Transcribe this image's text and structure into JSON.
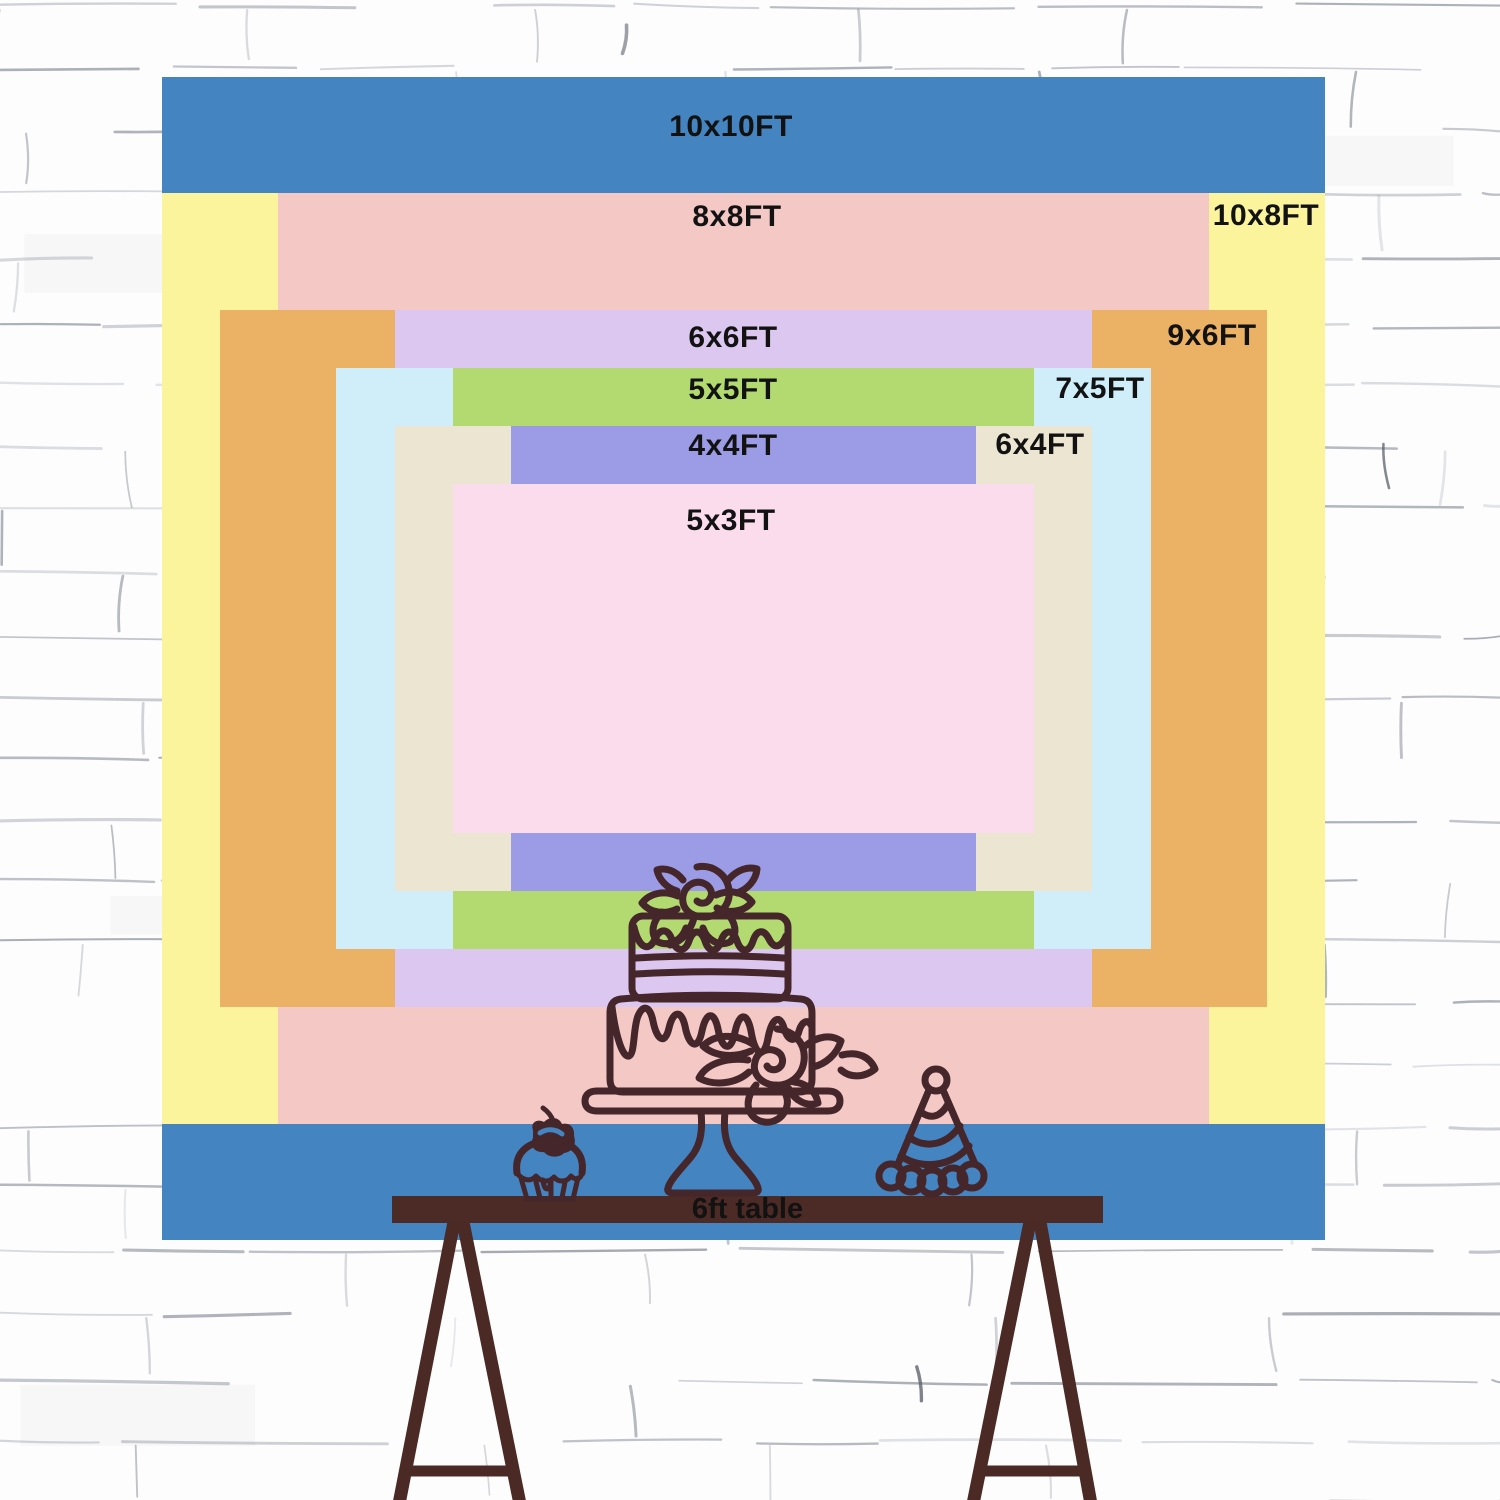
{
  "scene": {
    "description": "Backdrop size comparison chart hung on a white brick wall, with line-art cake table in front",
    "wall_bg": "#fdfdfd",
    "wall_line": "#6e7583",
    "wall_accent": "#555c66"
  },
  "board": {
    "left_px": 162,
    "top_px": 77,
    "width_px": 1163,
    "height_px": 1163,
    "base_ft": 10
  },
  "layers": [
    {
      "id": "10x10",
      "label": "10x10FT",
      "w_ft": 10,
      "h_ft": 10,
      "color": "#4484c1",
      "label_x": 731,
      "label_y": 127
    },
    {
      "id": "10x8",
      "label": "10x8FT",
      "w_ft": 10,
      "h_ft": 8,
      "color": "#fbf49c",
      "label_x": 1266,
      "label_y": 216
    },
    {
      "id": "8x8",
      "label": "8x8FT",
      "w_ft": 8,
      "h_ft": 8,
      "color": "#f3c8c5",
      "label_x": 737,
      "label_y": 217
    },
    {
      "id": "9x6",
      "label": "9x6FT",
      "w_ft": 9,
      "h_ft": 6,
      "color": "#ebb164",
      "label_x": 1212,
      "label_y": 336
    },
    {
      "id": "6x6",
      "label": "6x6FT",
      "w_ft": 6,
      "h_ft": 6,
      "color": "#dbc7ef",
      "label_x": 733,
      "label_y": 338
    },
    {
      "id": "7x5",
      "label": "7x5FT",
      "w_ft": 7,
      "h_ft": 5,
      "color": "#cfeef9",
      "label_x": 1100,
      "label_y": 389
    },
    {
      "id": "5x5",
      "label": "5x5FT",
      "w_ft": 5,
      "h_ft": 5,
      "color": "#b3da70",
      "label_x": 733,
      "label_y": 390
    },
    {
      "id": "6x4",
      "label": "6x4FT",
      "w_ft": 6,
      "h_ft": 4,
      "color": "#ebe5d2",
      "label_x": 1040,
      "label_y": 445
    },
    {
      "id": "4x4",
      "label": "4x4FT",
      "w_ft": 4,
      "h_ft": 4,
      "color": "#9c9ce6",
      "label_x": 733,
      "label_y": 446
    },
    {
      "id": "5x3",
      "label": "5x3FT",
      "w_ft": 5,
      "h_ft": 3,
      "color": "#fbdcec",
      "label_x": 731,
      "label_y": 521
    }
  ],
  "table": {
    "label": "6ft table",
    "bar_color": "#4c2a26",
    "leg_color": "#4b2a25",
    "text_color": "#121212"
  },
  "illustration": {
    "stroke": "#44262b",
    "items": [
      "tiered-cake",
      "cupcake-with-cherry",
      "party-hat"
    ]
  }
}
